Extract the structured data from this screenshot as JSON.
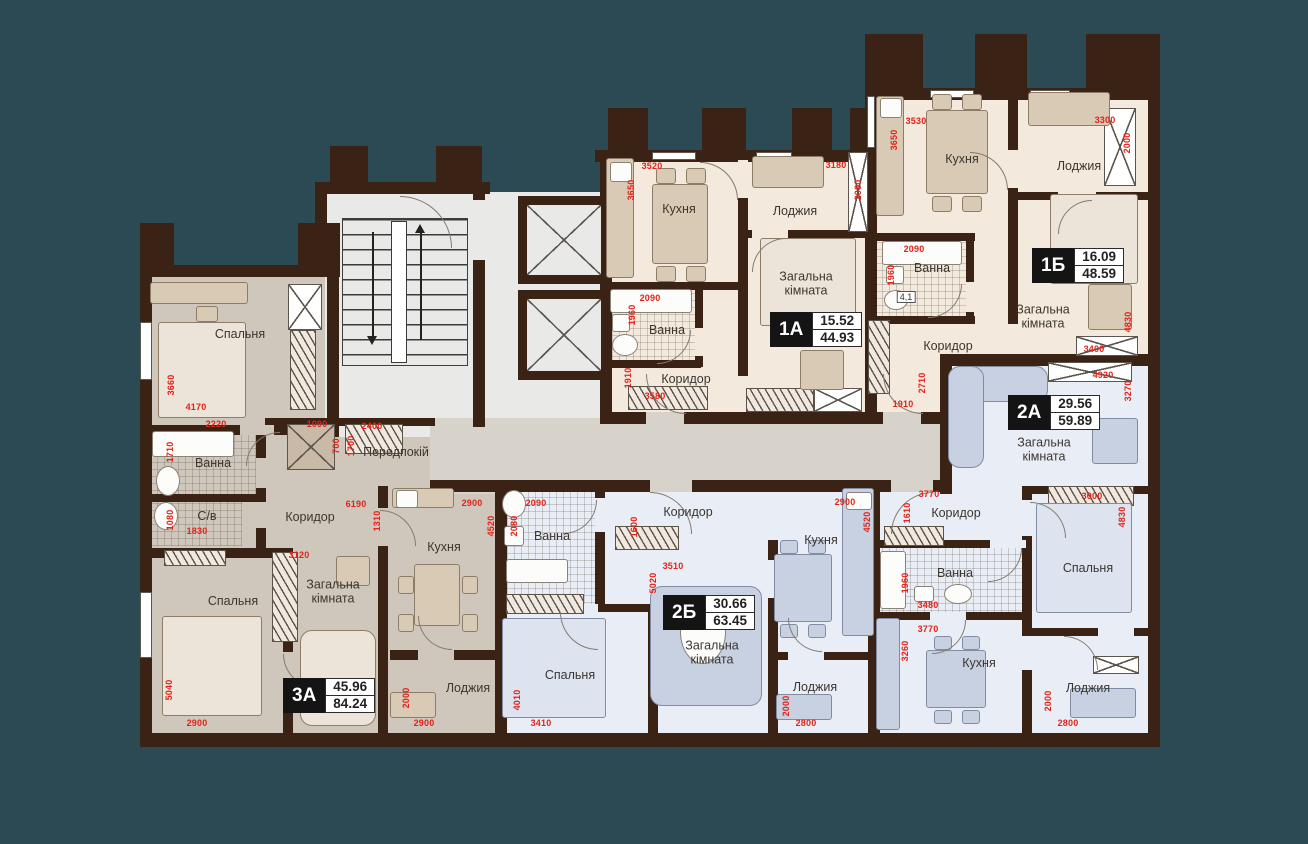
{
  "plan": {
    "apartments": [
      {
        "id": "1А",
        "living_area": "15.52",
        "total_area": "44.93",
        "x": 770,
        "y": 312
      },
      {
        "id": "1Б",
        "living_area": "16.09",
        "total_area": "48.59",
        "x": 1032,
        "y": 248
      },
      {
        "id": "2А",
        "living_area": "29.56",
        "total_area": "59.89",
        "x": 1008,
        "y": 395
      },
      {
        "id": "2Б",
        "living_area": "30.66",
        "total_area": "63.45",
        "x": 663,
        "y": 595
      },
      {
        "id": "3А",
        "living_area": "45.96",
        "total_area": "84.24",
        "x": 283,
        "y": 678
      }
    ],
    "room_labels": [
      {
        "t": "Спальня",
        "x": 240,
        "y": 334
      },
      {
        "t": "Ванна",
        "x": 213,
        "y": 463
      },
      {
        "t": "С/в",
        "x": 207,
        "y": 516
      },
      {
        "t": "Коридор",
        "x": 310,
        "y": 517
      },
      {
        "t": "Спальня",
        "x": 233,
        "y": 601
      },
      {
        "t": "Загальна кімната",
        "x": 333,
        "y": 592,
        "w": 92
      },
      {
        "t": "Кухня",
        "x": 444,
        "y": 547
      },
      {
        "t": "Лоджия",
        "x": 468,
        "y": 688
      },
      {
        "t": "Передпокій",
        "x": 396,
        "y": 452
      },
      {
        "t": "Кухня",
        "x": 679,
        "y": 209
      },
      {
        "t": "Лоджия",
        "x": 795,
        "y": 211
      },
      {
        "t": "Загальна кімната",
        "x": 806,
        "y": 284,
        "w": 92
      },
      {
        "t": "Ванна",
        "x": 667,
        "y": 330
      },
      {
        "t": "Коридор",
        "x": 686,
        "y": 379
      },
      {
        "t": "Кухня",
        "x": 962,
        "y": 159
      },
      {
        "t": "Лоджия",
        "x": 1079,
        "y": 166
      },
      {
        "t": "Ванна",
        "x": 932,
        "y": 268
      },
      {
        "t": "Коридор",
        "x": 948,
        "y": 346
      },
      {
        "t": "Загальна кімната",
        "x": 1043,
        "y": 317,
        "w": 96
      },
      {
        "t": "Загальна кімната",
        "x": 1044,
        "y": 450,
        "w": 96
      },
      {
        "t": "Коридор",
        "x": 956,
        "y": 513
      },
      {
        "t": "Ванна",
        "x": 955,
        "y": 573
      },
      {
        "t": "Спальня",
        "x": 1088,
        "y": 568
      },
      {
        "t": "Кухня",
        "x": 979,
        "y": 663
      },
      {
        "t": "Лоджия",
        "x": 1088,
        "y": 688
      },
      {
        "t": "Ванна",
        "x": 552,
        "y": 536
      },
      {
        "t": "Коридор",
        "x": 688,
        "y": 512
      },
      {
        "t": "Кухня",
        "x": 821,
        "y": 540
      },
      {
        "t": "Спальня",
        "x": 570,
        "y": 675
      },
      {
        "t": "Загальна кімната",
        "x": 712,
        "y": 653,
        "w": 96
      },
      {
        "t": "Лоджия",
        "x": 815,
        "y": 687
      }
    ],
    "small_labels": [
      {
        "t": "4,1",
        "x": 906,
        "y": 297
      }
    ],
    "dim_labels": [
      {
        "t": "3660",
        "x": 171,
        "y": 385,
        "v": true
      },
      {
        "t": "4170",
        "x": 196,
        "y": 407,
        "v": false
      },
      {
        "t": "2220",
        "x": 216,
        "y": 424,
        "v": false
      },
      {
        "t": "1710",
        "x": 170,
        "y": 452,
        "v": true
      },
      {
        "t": "1080",
        "x": 170,
        "y": 520,
        "v": true
      },
      {
        "t": "1830",
        "x": 197,
        "y": 531,
        "v": false
      },
      {
        "t": "5040",
        "x": 169,
        "y": 690,
        "v": true
      },
      {
        "t": "2900",
        "x": 197,
        "y": 723,
        "v": false
      },
      {
        "t": "3120",
        "x": 299,
        "y": 555,
        "v": false
      },
      {
        "t": "6190",
        "x": 356,
        "y": 504,
        "v": false
      },
      {
        "t": "1310",
        "x": 377,
        "y": 521,
        "v": true
      },
      {
        "t": "1090",
        "x": 317,
        "y": 424,
        "v": false
      },
      {
        "t": "700",
        "x": 336,
        "y": 446,
        "v": true
      },
      {
        "t": "1700",
        "x": 351,
        "y": 446,
        "v": true
      },
      {
        "t": "2400",
        "x": 372,
        "y": 426,
        "v": false
      },
      {
        "t": "2900",
        "x": 472,
        "y": 503,
        "v": false
      },
      {
        "t": "4520",
        "x": 491,
        "y": 526,
        "v": true
      },
      {
        "t": "2000",
        "x": 406,
        "y": 698,
        "v": true
      },
      {
        "t": "2900",
        "x": 424,
        "y": 723,
        "v": false
      },
      {
        "t": "3520",
        "x": 652,
        "y": 166,
        "v": false
      },
      {
        "t": "3650",
        "x": 631,
        "y": 190,
        "v": true
      },
      {
        "t": "3180",
        "x": 836,
        "y": 165,
        "v": false
      },
      {
        "t": "2000",
        "x": 858,
        "y": 190,
        "v": true
      },
      {
        "t": "2090",
        "x": 650,
        "y": 298,
        "v": false
      },
      {
        "t": "1960",
        "x": 632,
        "y": 315,
        "v": true
      },
      {
        "t": "1910",
        "x": 628,
        "y": 378,
        "v": true
      },
      {
        "t": "3580",
        "x": 655,
        "y": 396,
        "v": false
      },
      {
        "t": "3530",
        "x": 916,
        "y": 121,
        "v": false
      },
      {
        "t": "3650",
        "x": 894,
        "y": 140,
        "v": true
      },
      {
        "t": "3300",
        "x": 1105,
        "y": 120,
        "v": false
      },
      {
        "t": "2000",
        "x": 1127,
        "y": 143,
        "v": true
      },
      {
        "t": "2090",
        "x": 914,
        "y": 249,
        "v": false
      },
      {
        "t": "1960",
        "x": 891,
        "y": 275,
        "v": true
      },
      {
        "t": "2710",
        "x": 922,
        "y": 383,
        "v": true
      },
      {
        "t": "1910",
        "x": 903,
        "y": 404,
        "v": false
      },
      {
        "t": "3400",
        "x": 1094,
        "y": 349,
        "v": false
      },
      {
        "t": "4830",
        "x": 1128,
        "y": 322,
        "v": true
      },
      {
        "t": "4920",
        "x": 1103,
        "y": 375,
        "v": false
      },
      {
        "t": "3270",
        "x": 1128,
        "y": 391,
        "v": true
      },
      {
        "t": "3770",
        "x": 929,
        "y": 494,
        "v": false
      },
      {
        "t": "1610",
        "x": 907,
        "y": 513,
        "v": true
      },
      {
        "t": "3000",
        "x": 1092,
        "y": 496,
        "v": false
      },
      {
        "t": "4830",
        "x": 1122,
        "y": 517,
        "v": true
      },
      {
        "t": "1960",
        "x": 905,
        "y": 583,
        "v": true
      },
      {
        "t": "3480",
        "x": 928,
        "y": 605,
        "v": false
      },
      {
        "t": "3770",
        "x": 928,
        "y": 629,
        "v": false
      },
      {
        "t": "3260",
        "x": 905,
        "y": 651,
        "v": true
      },
      {
        "t": "2000",
        "x": 1048,
        "y": 701,
        "v": true
      },
      {
        "t": "2800",
        "x": 1068,
        "y": 723,
        "v": false
      },
      {
        "t": "2090",
        "x": 536,
        "y": 503,
        "v": false
      },
      {
        "t": "2080",
        "x": 514,
        "y": 526,
        "v": true
      },
      {
        "t": "1600",
        "x": 634,
        "y": 527,
        "v": true
      },
      {
        "t": "2900",
        "x": 845,
        "y": 502,
        "v": false
      },
      {
        "t": "4520",
        "x": 867,
        "y": 522,
        "v": true
      },
      {
        "t": "3510",
        "x": 673,
        "y": 566,
        "v": false
      },
      {
        "t": "5020",
        "x": 653,
        "y": 583,
        "v": true
      },
      {
        "t": "4010",
        "x": 517,
        "y": 700,
        "v": true
      },
      {
        "t": "3410",
        "x": 541,
        "y": 723,
        "v": false
      },
      {
        "t": "2000",
        "x": 786,
        "y": 706,
        "v": true
      },
      {
        "t": "2800",
        "x": 806,
        "y": 723,
        "v": false
      }
    ],
    "colors": {
      "background": "#2b4a53",
      "wall": "#3a2314",
      "dim_red": "#e2231a",
      "floor_cream": "#f3eadd",
      "floor_blue": "#e9eef6",
      "floor_taupe": "#cfc7bc",
      "floor_grey": "#e9e9e7",
      "floor_hall": "#d7d2ca",
      "badge_black": "#141414"
    }
  }
}
